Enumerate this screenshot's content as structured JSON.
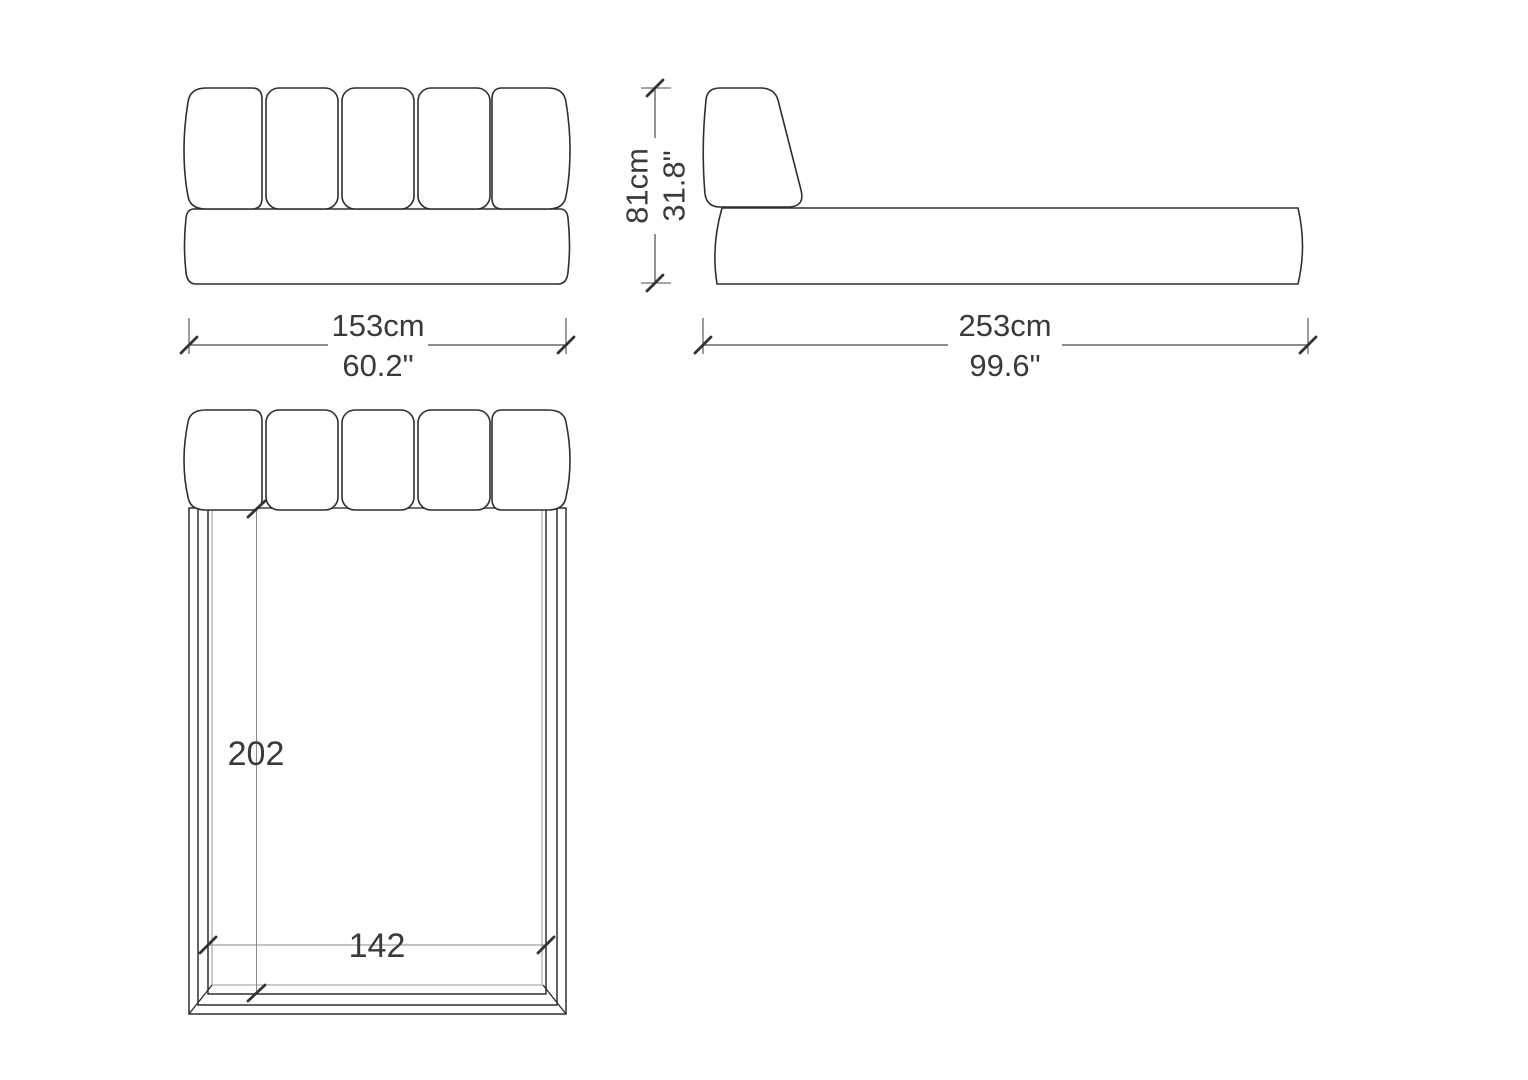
{
  "dimensions": {
    "front_width_cm": "153cm",
    "front_width_in": "60.2\"",
    "length_cm": "253cm",
    "length_in": "99.6\"",
    "height_cm": "81cm",
    "height_in": "31.8\"",
    "mattress_length_cm": "202",
    "mattress_width_cm": "142"
  },
  "colors": {
    "background": "#ffffff",
    "outline": "#2f2f2f",
    "dimension_line": "#4a4a4a",
    "thin_dimension_line": "#8a8a8a",
    "text": "#3a3a3a"
  }
}
